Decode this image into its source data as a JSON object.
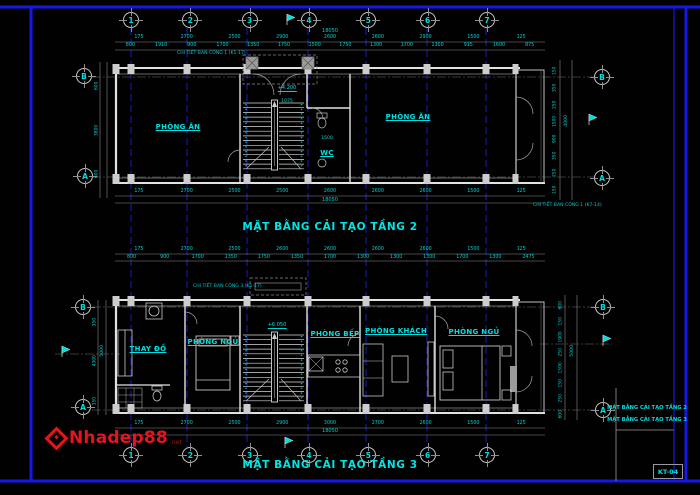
{
  "sheet": {
    "drawing_code": "KT-04"
  },
  "watermark": {
    "name": "Nhadep88",
    "suffix": ".net"
  },
  "grid": {
    "cols": [
      "1",
      "2",
      "3",
      "4",
      "5",
      "6",
      "7"
    ],
    "row_b": "B",
    "row_a": "A"
  },
  "plan2": {
    "title": "MẶT BẰNG CẢI TẠO TẦNG 2",
    "room_dining_left": "PHÒNG ĂN",
    "room_wc": "WC",
    "room_dining_right": "PHÒNG ĂN",
    "note_top": "CHI TIẾT BAN CÔNG 1 (K1-17)",
    "note_right": "CHI TIẾT BAN CÔNG 1 (K7-14)",
    "elevation": "+4.200",
    "stair_dim": "1075",
    "wc_dim": "1500",
    "dims_top_major": [
      "175",
      "2700",
      "2500",
      "2900",
      "2600",
      "2600",
      "2900",
      "1500",
      "125"
    ],
    "dims_top_minor": [
      "800",
      "1910",
      "900",
      "1700",
      "1350",
      "1750",
      "1500",
      "1750",
      "1300",
      "1700",
      "1300",
      "915",
      "1600",
      "875"
    ],
    "dims_top_total": "18050",
    "dims_bottom": [
      "175",
      "2700",
      "2500",
      "2500",
      "2600",
      "2600",
      "2600",
      "1500",
      "125"
    ],
    "dims_bottom_total": "18050",
    "vdims_left": [
      "600",
      "3800",
      "600"
    ],
    "vdims_right": [
      "150",
      "350",
      "250",
      "1500",
      "900",
      "350",
      "250",
      "150"
    ],
    "vdims_right_total": "4000"
  },
  "plan3": {
    "title": "MẶT BẰNG CẢI TẠO TẦNG 3",
    "room_changing": "THAY ĐỒ",
    "room_bed_left": "PHÒNG NGỦ",
    "room_kitchen": "PHÒNG BẾP",
    "room_living": "PHÒNG KHÁCH",
    "room_bed_right": "PHÒNG NGỦ",
    "note_top": "CHI TIẾT BAN CÔNG 3 (K1-17)",
    "elevation": "+6.050",
    "dims_top_major": [
      "175",
      "2700",
      "2500",
      "2600",
      "2600",
      "2600",
      "2600",
      "1500",
      "125"
    ],
    "dims_top_minor": [
      "800",
      "900",
      "1700",
      "1350",
      "1750",
      "1350",
      "1700",
      "1300",
      "1300",
      "1300",
      "1700",
      "1300",
      "2475"
    ],
    "dims_bottom": [
      "175",
      "2700",
      "2500",
      "2900",
      "3000",
      "2700",
      "2600",
      "1500",
      "125"
    ],
    "dims_bottom_total": "18050",
    "vdims_left": [
      "350",
      "4300",
      "350"
    ],
    "vdims_left_total": "5000",
    "vdims_right": [
      "600",
      "150",
      "1900",
      "250",
      "1500",
      "150",
      "250",
      "600"
    ],
    "vdims_right_total": "5000"
  },
  "titleblock": {
    "line1": "MẶT BẰNG CẢI TẠO TẦNG 2",
    "line2": "MẶT BẰNG CẢI TẠO TẦNG 3",
    "code": "KT-04"
  },
  "colors": {
    "accent_cyan": "#00e0e0",
    "frame_blue": "#1717e8",
    "grid_blue": "#1f1fd6",
    "wall_gray": "#e2e2e2",
    "watermark_red": "#e8131d"
  }
}
